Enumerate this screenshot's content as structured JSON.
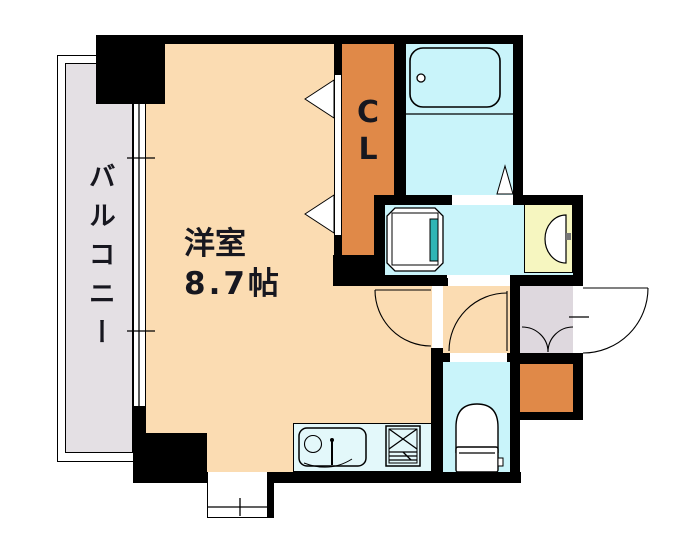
{
  "floor_plan": {
    "labels": {
      "balcony": "バルコニー",
      "room_name": "洋室",
      "room_size": "8.7帖",
      "closet_top": "C",
      "closet_bottom": "L"
    },
    "colors": {
      "background": "#ffffff",
      "wall": "#000000",
      "line": "#000000",
      "room": "#fbdcb2",
      "closet_orange": "#e08948",
      "water_cyan": "#c9f4fa",
      "counter_cyan": "#e3f8fa",
      "balcony_gray": "#e4e0e4",
      "entrance_gray": "#ded8de",
      "basin_yellow": "#f6f6c0",
      "washer_teal": "#2fb5b5",
      "text": "#17171f"
    }
  }
}
